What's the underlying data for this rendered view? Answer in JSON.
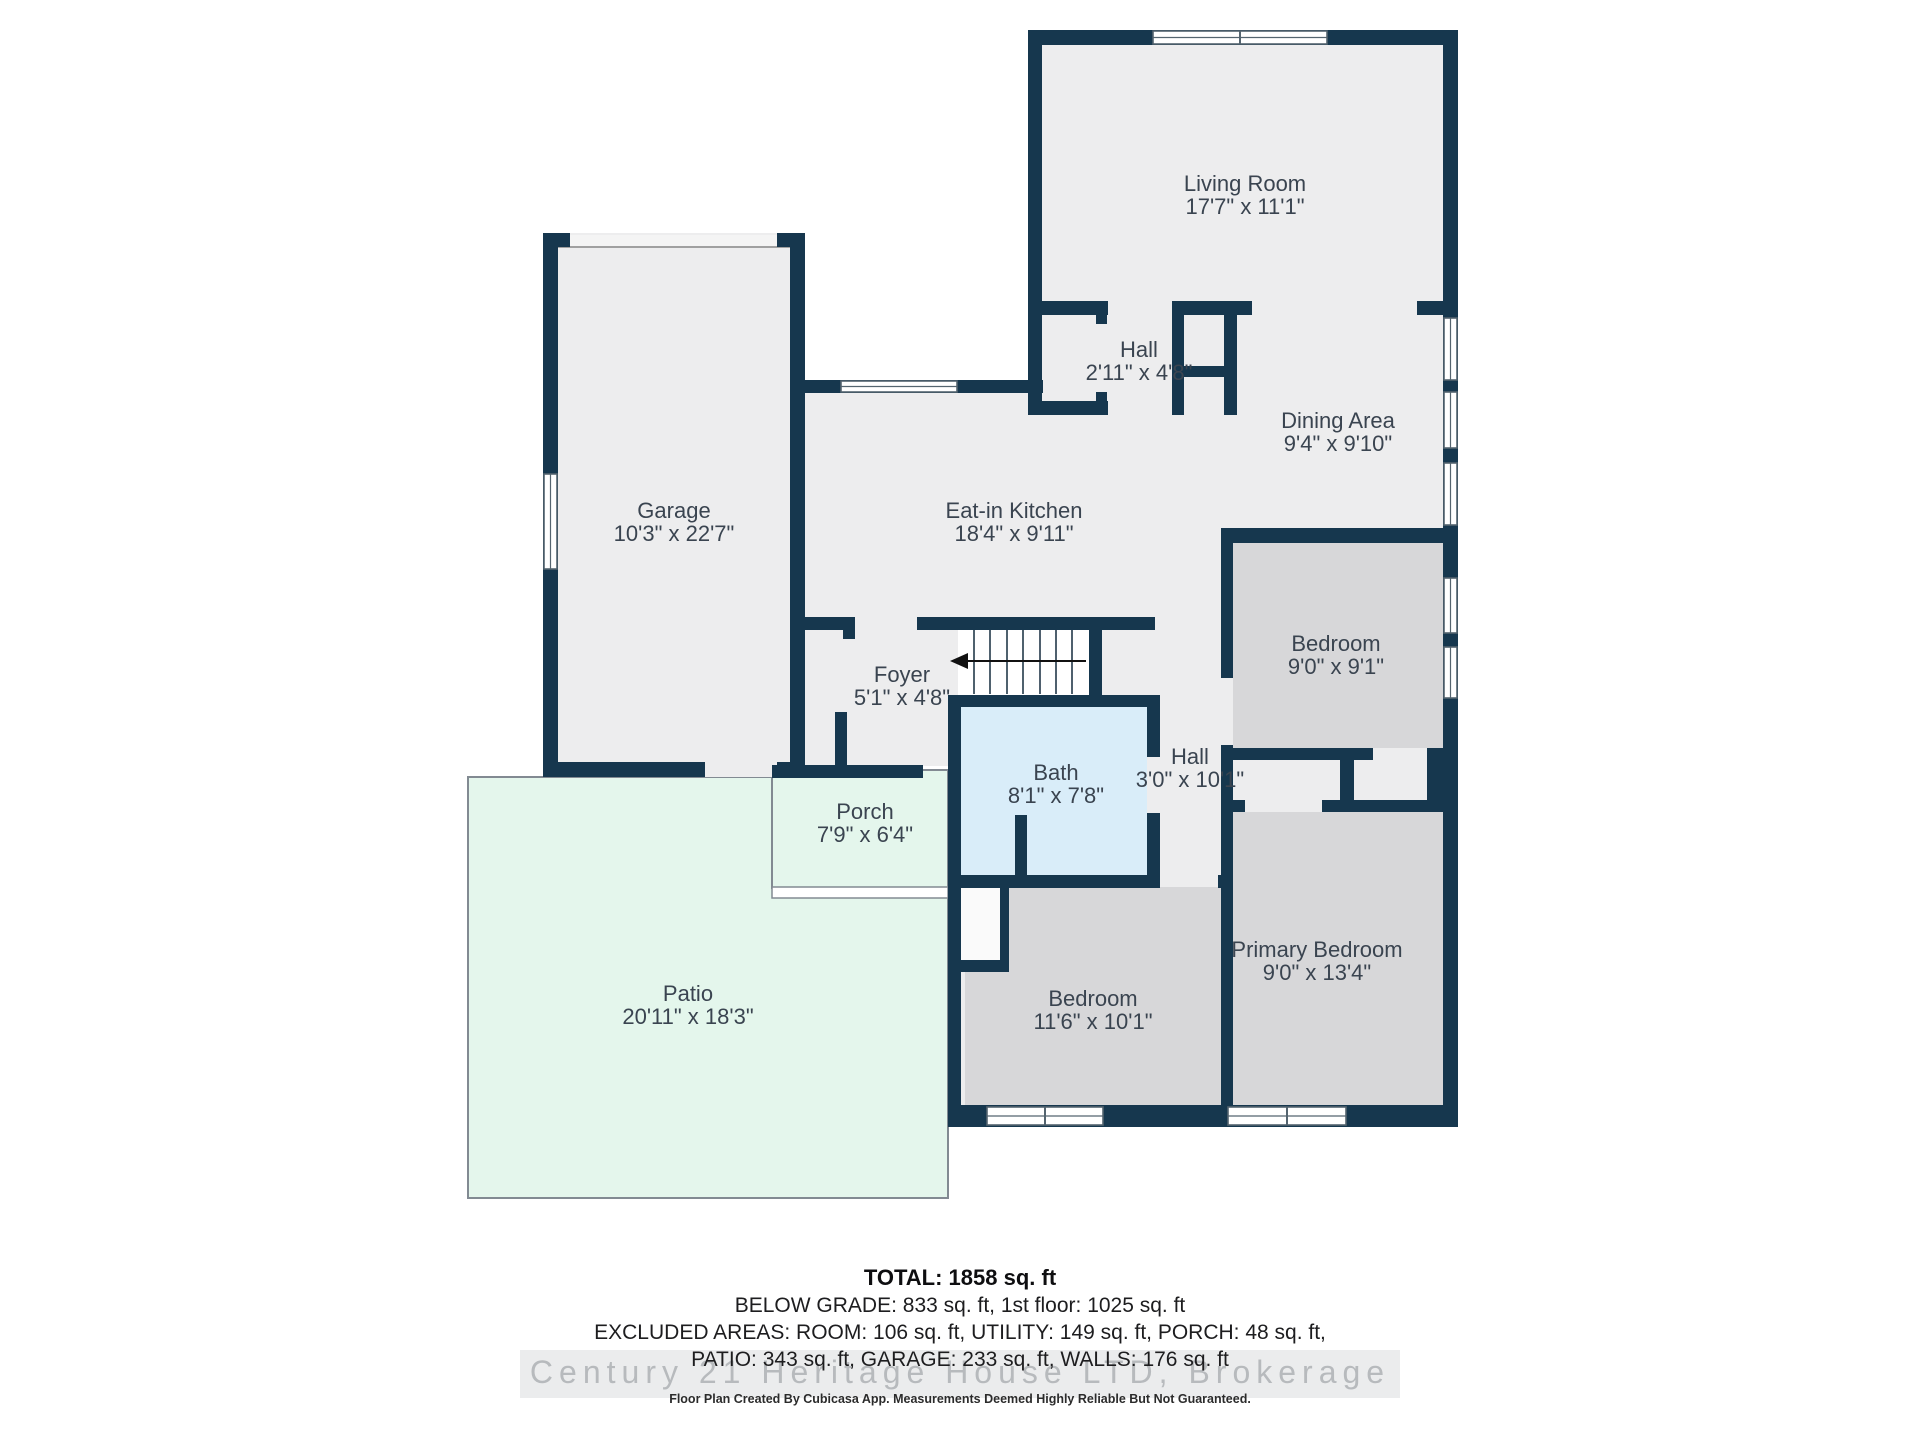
{
  "rooms": {
    "living": {
      "name": "Living Room",
      "dims": "17'7\" x 11'1\""
    },
    "hall_small": {
      "name": "Hall",
      "dims": "2'11\" x 4'8\""
    },
    "dining": {
      "name": "Dining Area",
      "dims": "9'4\" x 9'10\""
    },
    "garage": {
      "name": "Garage",
      "dims": "10'3\" x 22'7\""
    },
    "kitchen": {
      "name": "Eat-in Kitchen",
      "dims": "18'4\" x 9'11\""
    },
    "foyer": {
      "name": "Foyer",
      "dims": "5'1\" x 4'8\""
    },
    "bath": {
      "name": "Bath",
      "dims": "8'1\" x 7'8\""
    },
    "hall": {
      "name": "Hall",
      "dims": "3'0\" x 10'1\""
    },
    "bedroom": {
      "name": "Bedroom",
      "dims": "9'0\" x 9'1\""
    },
    "primary": {
      "name": "Primary Bedroom",
      "dims": "9'0\" x 13'4\""
    },
    "bedroom2": {
      "name": "Bedroom",
      "dims": "11'6\" x 10'1\""
    },
    "porch": {
      "name": "Porch",
      "dims": "7'9\" x 6'4\""
    },
    "patio": {
      "name": "Patio",
      "dims": "20'11\" x 18'3\""
    }
  },
  "stairs": {
    "arrow_direction": "left"
  },
  "footer": {
    "total": "TOTAL: 1858 sq. ft",
    "line1": "BELOW GRADE: 833 sq. ft, 1st floor: 1025 sq. ft",
    "line2": "EXCLUDED AREAS: ROOM: 106 sq. ft, UTILITY: 149 sq. ft, PORCH: 48 sq. ft,",
    "line3": "PATIO: 343 sq. ft, GARAGE: 233 sq. ft, WALLS: 176 sq. ft",
    "watermark": "Century 21 Heritage House LTD, Brokerage",
    "disclaimer": "Floor Plan Created By Cubicasa App. Measurements Deemed Highly Reliable But Not Guaranteed."
  },
  "colors": {
    "wall": "#16374e",
    "floor": "#ededee",
    "bedroom": "#d7d7d9",
    "bath": "#d9edf9",
    "outdoor": "#e4f6ec",
    "stairs_bg": "#ffffff",
    "niche": "#fafafa",
    "window_frame": "#54646f",
    "garage_door": "#f4f4f4",
    "label": "#3a4450",
    "patio_border": "#828a92"
  }
}
